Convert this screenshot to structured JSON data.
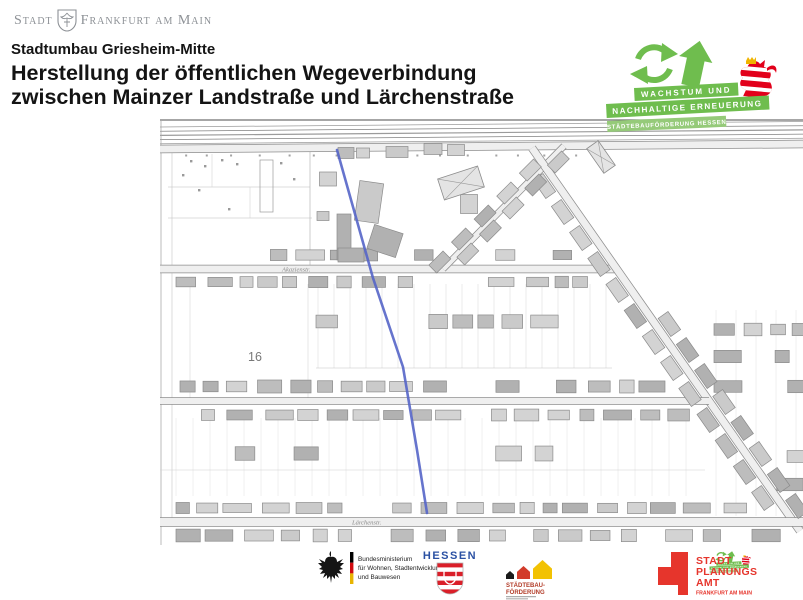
{
  "city_logo": {
    "prefix": "Stadt",
    "name": "Frankfurt am Main"
  },
  "header": {
    "subtitle": "Stadtumbau Griesheim-Mitte",
    "title_line1": "Herstellung der öffentlichen Wegeverbindung",
    "title_line2": "zwischen Mainzer Landstraße und Lärchenstraße"
  },
  "wachstum_logo": {
    "banner1": "WACHSTUM UND",
    "banner2": "NACHHALTIGE ERNEUERUNG",
    "banner3": "STÄDTEBAUFÖRDERUNG HESSEN",
    "green": "#6fbd4e",
    "light_green": "#95ca79",
    "lion_red": "#e2001a",
    "crown_gold": "#f0b400"
  },
  "map": {
    "street_label_1": "Akazienstr.",
    "street_label_2": "Lärchenstr.",
    "parcel_number": "16",
    "path": {
      "points": "177,32 213,160 243,249 257,332 267,395",
      "color": "#5565c8"
    }
  },
  "footer": {
    "bund": {
      "line1": "Bundesministerium",
      "line2": "für Wohnen, Stadtentwicklung",
      "line3": "und Bauwesen"
    },
    "hessen": {
      "label": "HESSEN",
      "blue": "#2b51a3",
      "red": "#da1f29"
    },
    "staedtebau": {
      "line1": "STÄDTEBAU-",
      "line2": "FÖRDERUNG",
      "red": "#b23c28",
      "black_house": "#1a1a1a",
      "red_house": "#d23b2a",
      "yellow_house": "#f2c203"
    },
    "spa": {
      "line1": "STADT",
      "line2": "PLANUNGS",
      "line3": "AMT",
      "sub": "FRANKFURT AM MAIN",
      "red": "#e6352c"
    }
  }
}
